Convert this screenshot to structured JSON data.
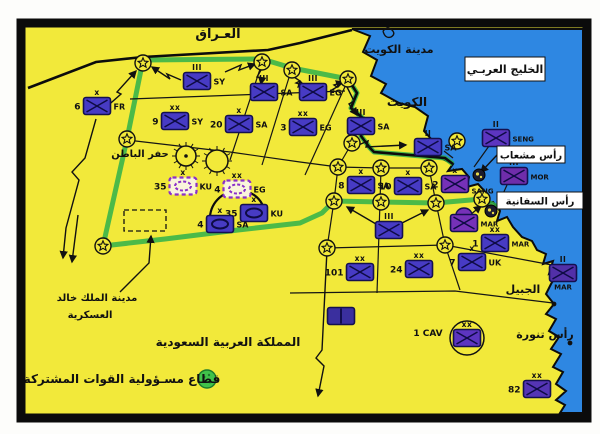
{
  "map_title": "Gulf War coalition deployment map",
  "colors": {
    "land": "#f2e93a",
    "sea": "#2e87e2",
    "frame": "#0b0b0b",
    "sector_green": "#2fb14b",
    "unit_blue": "#473bc4",
    "unit_purple": "#7631b8",
    "unit_dashed_stroke": "#8b2fc9",
    "legend_green": "#41c24a"
  },
  "region_labels": [
    {
      "id": "iraq",
      "text": "العـراق",
      "x": 218,
      "y": 38,
      "size": 13
    },
    {
      "id": "kuwait-city",
      "text": "مدينة الكويت",
      "x": 399,
      "y": 53,
      "size": 11
    },
    {
      "id": "kuwait",
      "text": "الكويت",
      "x": 407,
      "y": 106,
      "size": 12
    },
    {
      "id": "hafar-al-batin",
      "text": "حفر الباطن",
      "x": 140,
      "y": 157,
      "size": 10
    },
    {
      "id": "jubail",
      "text": "الجبيل",
      "x": 523,
      "y": 293,
      "size": 11
    },
    {
      "id": "ras-tanura",
      "text": "رأس تنورة",
      "x": 545,
      "y": 338,
      "size": 11
    },
    {
      "id": "saudi-arabia",
      "text": "المملكة العربية السعودية",
      "x": 228,
      "y": 346,
      "size": 12
    },
    {
      "id": "kkmc-line1",
      "text": "مدينة الملك خالد",
      "x": 97,
      "y": 301,
      "size": 10
    },
    {
      "id": "kkmc-line2",
      "text": "العسكرية",
      "x": 90,
      "y": 318,
      "size": 10
    },
    {
      "id": "1cav-label",
      "text": "1 CAV",
      "x": 428,
      "y": 336,
      "size": 9
    }
  ],
  "sea_boxes": [
    {
      "id": "arabian-gulf",
      "text": "الخليج العربـي",
      "x": 465,
      "y": 57,
      "w": 80,
      "h": 24,
      "size": 11
    },
    {
      "id": "ras-mishab",
      "text": "رأس مشعاب",
      "x": 497,
      "y": 146,
      "w": 68,
      "h": 17,
      "size": 10
    },
    {
      "id": "ras-safaniya",
      "text": "رأس السفانية",
      "x": 497,
      "y": 192,
      "w": 86,
      "h": 17,
      "size": 10
    }
  ],
  "legend": {
    "text": "قطاع مسـؤولية القوات المشتركة",
    "x": 122,
    "y": 383,
    "size": 12,
    "swatch": {
      "x": 207,
      "y": 379,
      "r": 9
    }
  },
  "units": [
    {
      "num": "",
      "name": "SY",
      "ech": "III",
      "x": 197,
      "y": 81,
      "fill": "#473bc4",
      "sym": "cross"
    },
    {
      "num": "6",
      "name": "FR",
      "ech": "x",
      "x": 97,
      "y": 106,
      "fill": "#473bc4",
      "sym": "cross"
    },
    {
      "num": "9",
      "name": "SY",
      "ech": "xx",
      "x": 175,
      "y": 121,
      "fill": "#473bc4",
      "sym": "cross"
    },
    {
      "num": "20",
      "name": "SA",
      "ech": "x",
      "x": 239,
      "y": 124,
      "fill": "#473bc4",
      "sym": "cross"
    },
    {
      "num": "3",
      "name": "EG",
      "ech": "xx",
      "x": 303,
      "y": 127,
      "fill": "#473bc4",
      "sym": "cross"
    },
    {
      "num": "",
      "name": "SA",
      "ech": "III",
      "x": 264,
      "y": 92,
      "fill": "#473bc4",
      "sym": "cross"
    },
    {
      "num": "",
      "name": "EG",
      "ech": "III",
      "x": 313,
      "y": 92,
      "fill": "#473bc4",
      "sym": "cross"
    },
    {
      "num": "",
      "name": "SA",
      "ech": "III",
      "x": 361,
      "y": 126,
      "fill": "#473bc4",
      "sym": "cross"
    },
    {
      "num": "",
      "name": "SA",
      "ech": "II",
      "x": 428,
      "y": 147,
      "fill": "#473bc4",
      "sym": "cross"
    },
    {
      "num": "8",
      "name": "SA",
      "ech": "x",
      "x": 361,
      "y": 185,
      "fill": "#473bc4",
      "sym": "cross"
    },
    {
      "num": "10",
      "name": "SA",
      "ech": "x",
      "x": 408,
      "y": 186,
      "fill": "#473bc4",
      "sym": "cross"
    },
    {
      "num": "2",
      "name": "SANG",
      "ech": "x",
      "x": 455,
      "y": 184,
      "fill": "#7631b8",
      "sym": "cross",
      "ndy": 6,
      "nsize": 7
    },
    {
      "num": "",
      "name": "SENG",
      "ech": "II",
      "x": 496,
      "y": 138,
      "fill": "#5c35c0",
      "sym": "cross",
      "nsize": 7
    },
    {
      "num": "",
      "name": "MOR",
      "ech": "III",
      "x": 514,
      "y": 176,
      "fill": "#6f2daa",
      "sym": "cross",
      "nsize": 7
    },
    {
      "num": "",
      "name": "MAR",
      "ech": "",
      "x": 464,
      "y": 223,
      "fill": "#7631b8",
      "sym": "cross",
      "amphib": true,
      "nsize": 7
    },
    {
      "num": "1",
      "name": "MAR",
      "ech": "xx",
      "x": 495,
      "y": 243,
      "fill": "#473bc4",
      "sym": "cross",
      "nsize": 7
    },
    {
      "num": "7",
      "name": "UK",
      "ech": "x",
      "x": 472,
      "y": 262,
      "fill": "#473bc4",
      "sym": "cross"
    },
    {
      "num": "",
      "name": "MAR",
      "ech": "II",
      "x": 563,
      "y": 273,
      "fill": "#5230a8",
      "sym": "cross",
      "nbelow": true,
      "nsize": 7
    },
    {
      "num": "",
      "name": "",
      "ech": "III",
      "x": 389,
      "y": 230,
      "fill": "#473bc4",
      "sym": "cross"
    },
    {
      "num": "101",
      "name": "",
      "ech": "xx",
      "x": 360,
      "y": 272,
      "fill": "#473bc4",
      "sym": "cross"
    },
    {
      "num": "24",
      "name": "",
      "ech": "xx",
      "x": 419,
      "y": 269,
      "fill": "#473bc4",
      "sym": "cross"
    },
    {
      "num": "",
      "name": "",
      "ech": "xx",
      "x": 467,
      "y": 338,
      "fill": "#5c35c0",
      "sym": "cross",
      "circled": true
    },
    {
      "num": "82",
      "name": "",
      "ech": "xx",
      "x": 537,
      "y": 389,
      "fill": "#5535b5",
      "sym": "cross"
    },
    {
      "num": "35",
      "name": "KU",
      "ech": "x",
      "x": 183,
      "y": 186,
      "fill": "#faf5dc",
      "sym": "oval",
      "dashed": true
    },
    {
      "num": "4",
      "name": "EG",
      "ech": "xx",
      "x": 237,
      "y": 189,
      "fill": "#faf5dc",
      "sym": "oval",
      "dashed": true
    },
    {
      "num": "35",
      "name": "KU",
      "ech": "x",
      "x": 254,
      "y": 213,
      "fill": "#473bc4",
      "sym": "oval"
    },
    {
      "num": "4",
      "name": "SA",
      "ech": "x",
      "x": 220,
      "y": 224,
      "fill": "#473bc4",
      "sym": "oval"
    },
    {
      "num": "",
      "name": "",
      "ech": "",
      "x": 341,
      "y": 316,
      "fill": "#3a2f9e",
      "sym": "split"
    }
  ],
  "stars": [
    [
      143,
      63
    ],
    [
      262,
      62
    ],
    [
      292,
      70
    ],
    [
      348,
      79
    ],
    [
      127,
      139
    ],
    [
      352,
      143
    ],
    [
      457,
      141
    ],
    [
      103,
      246
    ],
    [
      338,
      167
    ],
    [
      381,
      168
    ],
    [
      429,
      168
    ],
    [
      334,
      201
    ],
    [
      381,
      202
    ],
    [
      436,
      203
    ],
    [
      482,
      199
    ],
    [
      327,
      248
    ],
    [
      445,
      245
    ]
  ],
  "city_circles": [
    {
      "x": 186,
      "y": 156,
      "r": 10,
      "dot": true
    },
    {
      "x": 217,
      "y": 161,
      "r": 11,
      "dot": false
    }
  ],
  "port_symbols": [
    [
      479,
      175
    ],
    [
      491,
      211
    ]
  ],
  "coast_dots": [
    [
      554,
      304
    ],
    [
      570,
      343
    ]
  ]
}
